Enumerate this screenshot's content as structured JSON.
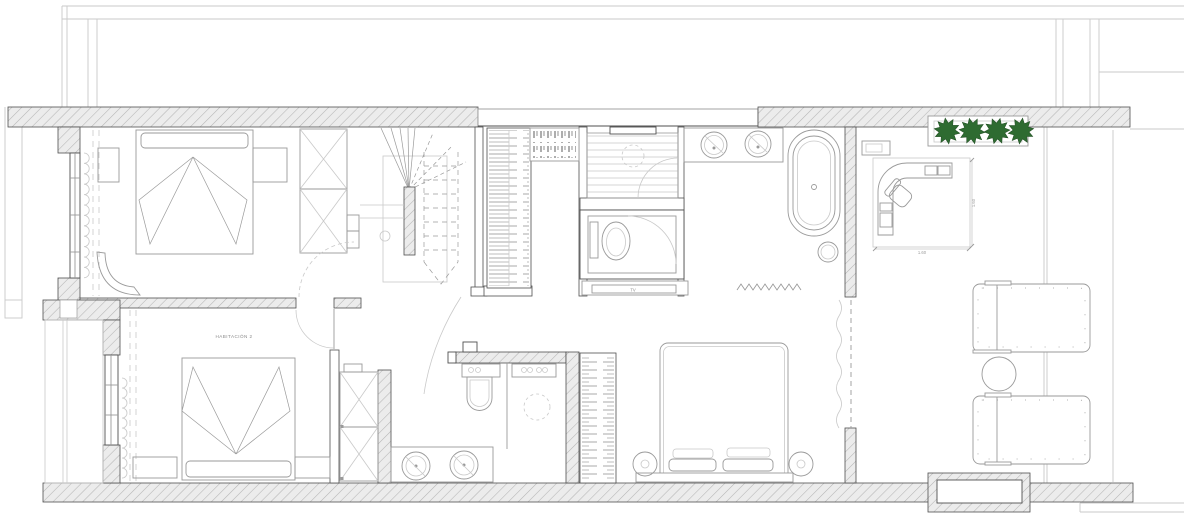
{
  "plan": {
    "rooms": {
      "bedroom2_label": "HABITACIÓN 2"
    },
    "labels": {
      "tv": "TV"
    },
    "dimensions": {
      "desk_width": "1.60",
      "desk_depth": "1.60"
    },
    "planter": {
      "plant_count": 4,
      "plant_icon": "potted-plant-icon"
    }
  },
  "colors": {
    "plant": "#2e6b31",
    "plantdark": "#1e4a20",
    "wallfill": "#ececec",
    "hatchline": "#b5b5b5",
    "line": "#9a9a9a",
    "dark": "#4f4f4f",
    "light": "#c9c9c9",
    "text": "#8a8a8a",
    "bg": "#ffffff"
  }
}
